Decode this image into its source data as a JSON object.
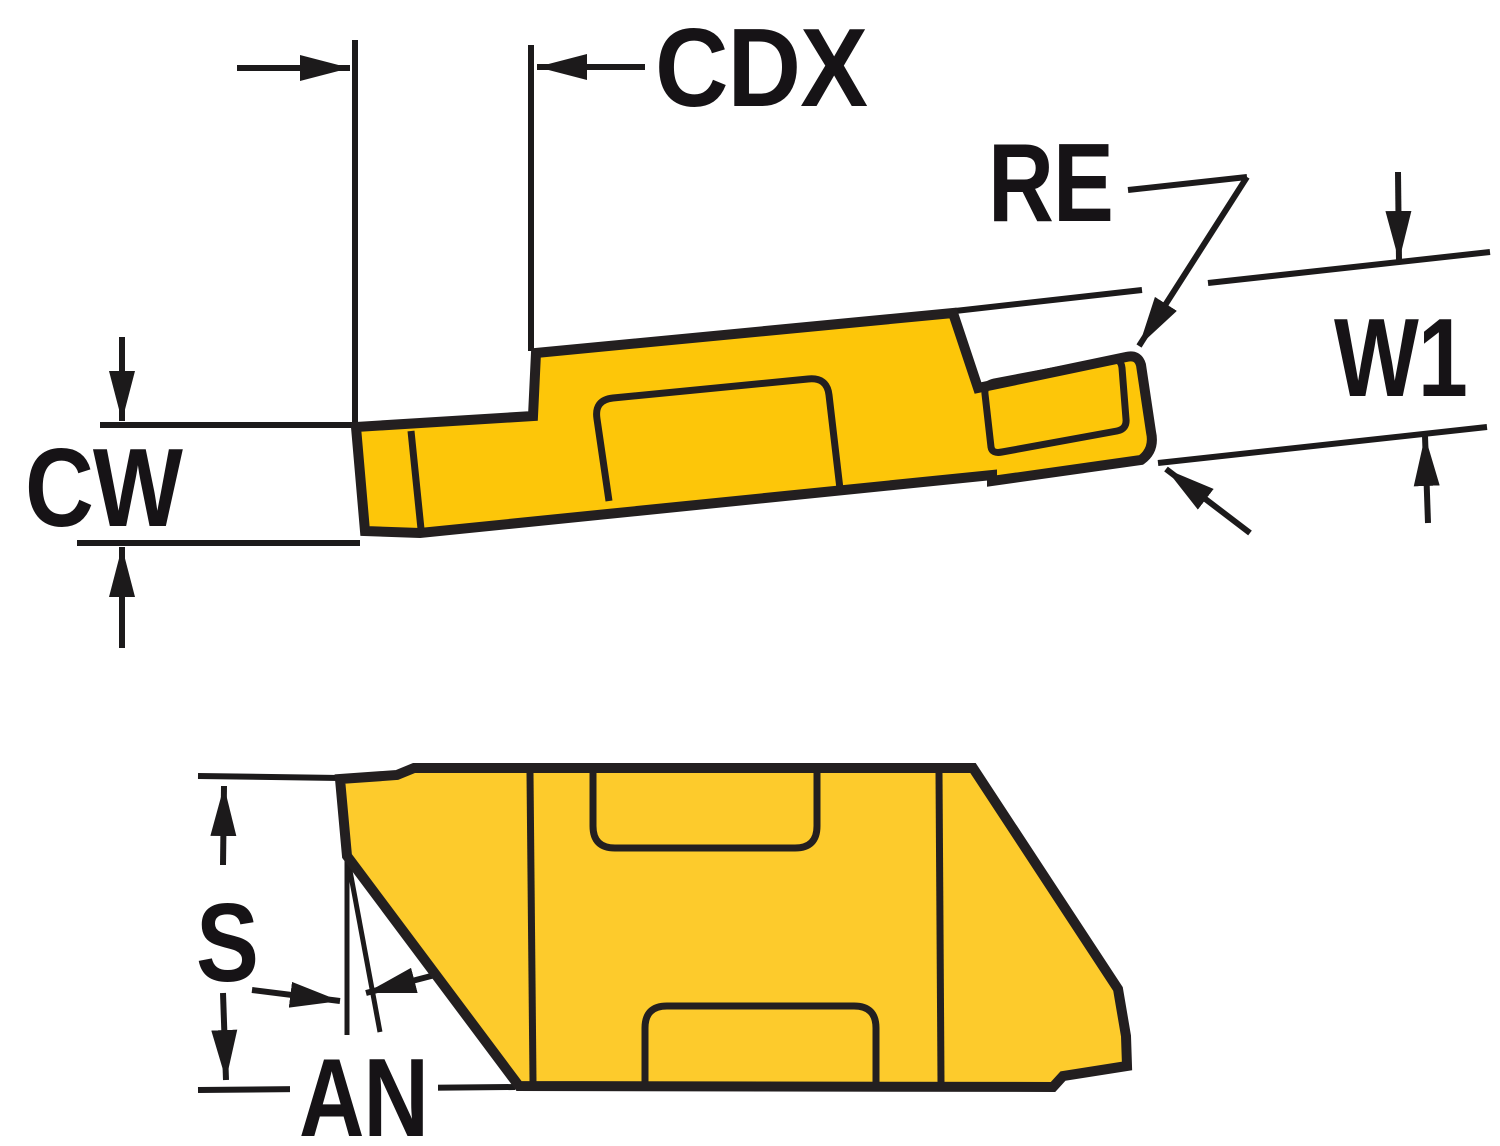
{
  "colors": {
    "background": "#ffffff",
    "outline": "#231f20",
    "dimension_line": "#1c1a1b",
    "label_text": "#161316",
    "insert_side_view_fill": "#fdc609",
    "insert_top_view_fill": "#fdcb2c"
  },
  "labels": {
    "cdx": "CDX",
    "re": "RE",
    "w1": "W1",
    "cw": "CW",
    "s": "S",
    "an": "AN"
  }
}
